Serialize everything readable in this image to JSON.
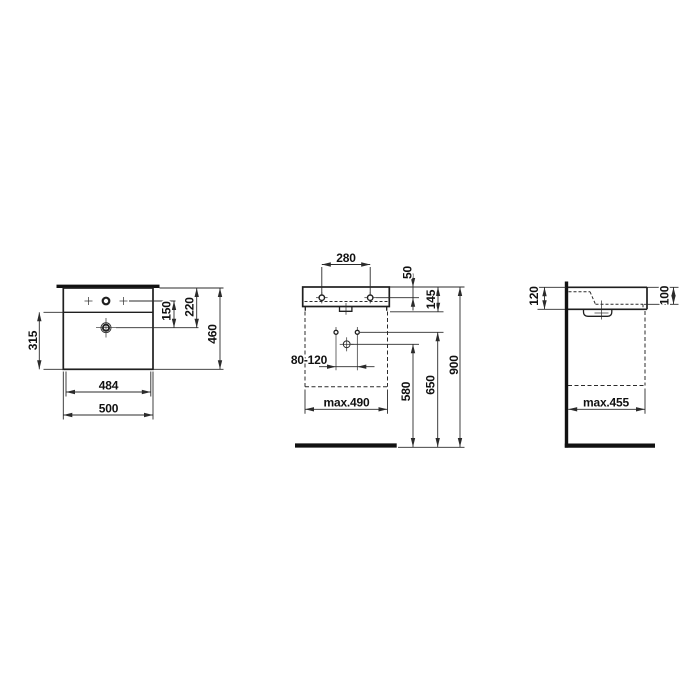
{
  "drawing": {
    "colors": {
      "line": "#2b2b2b",
      "object_line": "#1f1f1f",
      "datum_line": "#111111",
      "text": "#111111",
      "background": "#ffffff"
    },
    "views": {
      "plan": {
        "dims": {
          "front_depth": "315",
          "inner_width": "484",
          "outer_width": "500",
          "tap_to_drain": "150",
          "rear_to_drain": "220",
          "total_depth": "460"
        }
      },
      "front": {
        "dims": {
          "tap_hole_spacing": "280",
          "rim_to_holes": "50",
          "body_height": "145",
          "supply_spacing": "80-120",
          "max_width": "max.490",
          "drain_outlet_height": "580",
          "supply_height": "650",
          "rim_height": "900"
        }
      },
      "side": {
        "dims": {
          "front_edge_height": "120",
          "basin_depth": "100",
          "max_projection": "max.455"
        }
      }
    }
  }
}
